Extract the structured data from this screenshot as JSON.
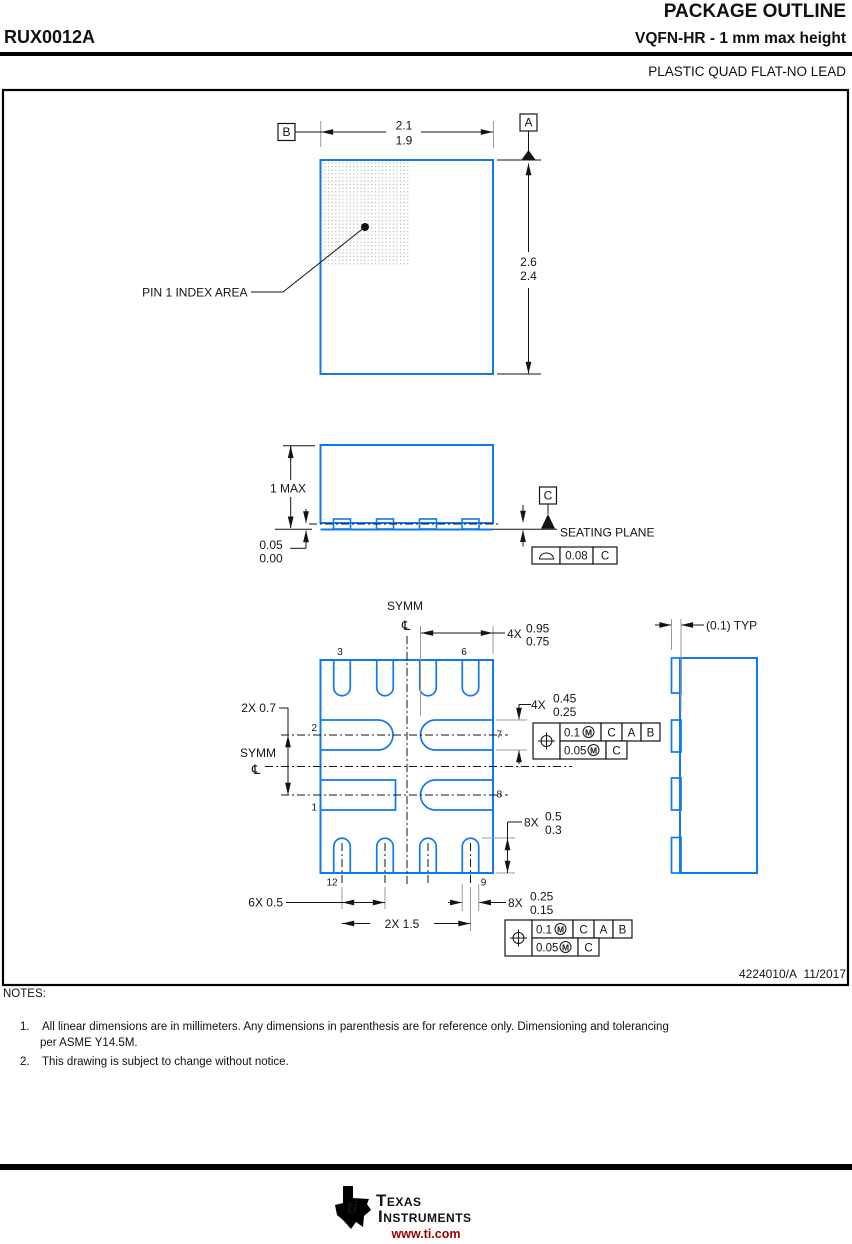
{
  "header": {
    "part_number": "RUX0012A",
    "title": "PACKAGE OUTLINE",
    "subtitle": "VQFN-HR - 1 mm max height",
    "package_type": "PLASTIC QUAD FLAT-NO LEAD"
  },
  "colors": {
    "outline_blue": "#1278ee",
    "url_red": "#990000"
  },
  "datums": {
    "a": "A",
    "b": "B",
    "c": "C"
  },
  "labels": {
    "pin1_index": "PIN 1 INDEX AREA",
    "seating_plane": "SEATING PLANE",
    "symm": "SYMM",
    "centerline": "℄"
  },
  "dims": {
    "body_w_max": "2.1",
    "body_w_min": "1.9",
    "body_h_max": "2.6",
    "body_h_min": "2.4",
    "pkg_height": "1 MAX",
    "standoff_max": "0.05",
    "standoff_min": "0.00",
    "flatness": "0.08",
    "lead_len_prefix": "4X",
    "lead_len_max": "0.95",
    "lead_len_min": "0.75",
    "pin_offset": "2X 0.7",
    "side_lead_prefix": "4X",
    "side_lead_max": "0.45",
    "side_lead_min": "0.25",
    "bot_lead_prefix": "8X",
    "bot_lead_max": "0.5",
    "bot_lead_min": "0.3",
    "pitch": "6X 0.5",
    "span": "2X 1.5",
    "lead_w_prefix": "8X",
    "lead_w_max": "0.25",
    "lead_w_min": "0.15",
    "detail_typ": "(0.1) TYP"
  },
  "pins": {
    "p1": "1",
    "p2": "2",
    "p3": "3",
    "p6": "6",
    "p7": "7",
    "p8": "8",
    "p9": "9",
    "p12": "12"
  },
  "fcf": {
    "tol_primary": "0.1",
    "tol_secondary": "0.05",
    "modifier": "M",
    "datum_1": "C",
    "datum_2": "A",
    "datum_3": "B"
  },
  "title_block": {
    "drawing_no": "4224010/A",
    "revision_date": "11/2017"
  },
  "notes": {
    "heading": "NOTES:",
    "items": [
      {
        "num": "1.",
        "lines": [
          "All linear dimensions are in millimeters. Any dimensions in parenthesis are for reference only. Dimensioning and tolerancing",
          "per ASME Y14.5M."
        ]
      },
      {
        "num": "2.",
        "lines": [
          "This drawing is subject to change without notice."
        ]
      }
    ]
  },
  "footer": {
    "brand_top": "Texas",
    "brand_bottom": "Instruments",
    "logo_letters": "ti",
    "url": "www.ti.com"
  }
}
